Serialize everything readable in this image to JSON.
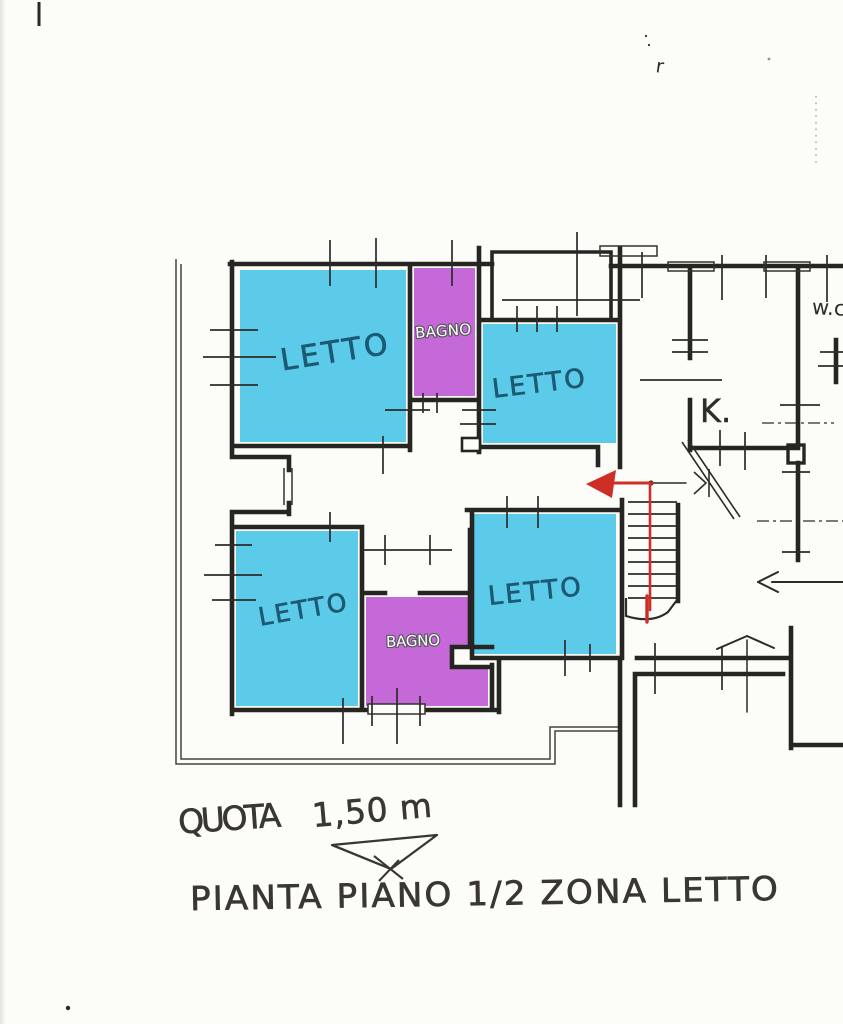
{
  "plan": {
    "rooms": {
      "letto_nw": {
        "label": "LETTO",
        "fill": "#5bcbe9"
      },
      "bagno_top": {
        "label": "BAGNO",
        "fill": "#c569d8"
      },
      "letto_ne": {
        "label": "LETTO",
        "fill": "#5bcbe9"
      },
      "kitchen": {
        "label": "K."
      },
      "wc": {
        "label": "w.c"
      },
      "letto_sw": {
        "label": "LETTO",
        "fill": "#5bcbe9"
      },
      "bagno_bottom": {
        "label": "BAGNO",
        "fill": "#c569d8"
      },
      "letto_s": {
        "label": "LETTO",
        "fill": "#5bcbe9"
      }
    },
    "annotations": {
      "quota_label": "QUOTA",
      "quota_value": "1,50 m",
      "caption": "PIANTA PIANO 1/2 ZONA LETTO",
      "stray_mark": "r"
    },
    "colors": {
      "room_cyan": "#5bcbe9",
      "room_magenta": "#c569d8",
      "wall_ink": "#262522",
      "route_red": "#cd2e25",
      "label_teal": "#1c5a74",
      "hand_ink": "#3a3733"
    }
  }
}
